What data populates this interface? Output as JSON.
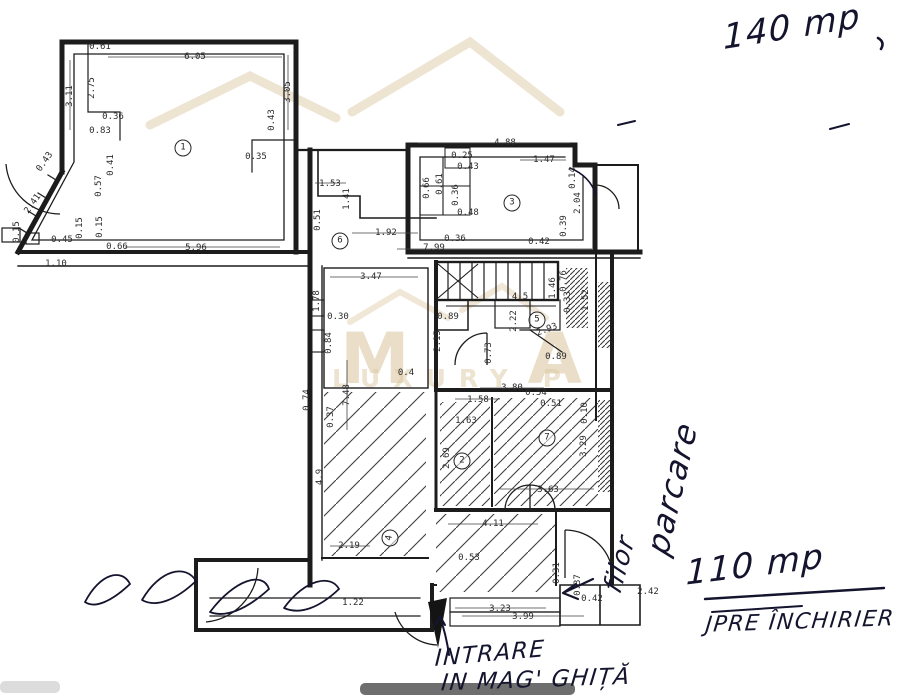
{
  "watermark": {
    "letters": "MA",
    "subtext": "LUXURY P",
    "color": "#d9c49c"
  },
  "plan": {
    "ink": "#1c1c1c",
    "dimensions": [
      {
        "t": "0.61",
        "x": 100,
        "y": 47
      },
      {
        "t": "6.05",
        "x": 195,
        "y": 57
      },
      {
        "t": "3.11",
        "x": 70,
        "y": 96,
        "r": -90
      },
      {
        "t": "2.75",
        "x": 92,
        "y": 88,
        "r": -90
      },
      {
        "t": "0.36",
        "x": 113,
        "y": 117
      },
      {
        "t": "0.83",
        "x": 100,
        "y": 131
      },
      {
        "t": "3.05",
        "x": 288,
        "y": 92,
        "r": -90
      },
      {
        "t": "0.43",
        "x": 272,
        "y": 120,
        "r": -90
      },
      {
        "t": "0.35",
        "x": 256,
        "y": 157
      },
      {
        "t": "0.41",
        "x": 111,
        "y": 165,
        "r": -90
      },
      {
        "t": "0.57",
        "x": 99,
        "y": 186,
        "r": -90
      },
      {
        "t": "0.43",
        "x": 45,
        "y": 162,
        "r": -55
      },
      {
        "t": "2.41",
        "x": 33,
        "y": 204,
        "r": -55
      },
      {
        "t": "0.15",
        "x": 17,
        "y": 232,
        "r": -90
      },
      {
        "t": "0.45",
        "x": 62,
        "y": 240
      },
      {
        "t": "0.15",
        "x": 80,
        "y": 228,
        "r": -90
      },
      {
        "t": "0.15",
        "x": 100,
        "y": 227,
        "r": -90
      },
      {
        "t": "0.66",
        "x": 117,
        "y": 247
      },
      {
        "t": "5.96",
        "x": 196,
        "y": 248
      },
      {
        "t": "1.10",
        "x": 56,
        "y": 264
      },
      {
        "t": "1.53",
        "x": 330,
        "y": 184
      },
      {
        "t": "1.41",
        "x": 347,
        "y": 199,
        "r": -90
      },
      {
        "t": "0.51",
        "x": 318,
        "y": 220,
        "r": -90
      },
      {
        "t": "1.92",
        "x": 386,
        "y": 233
      },
      {
        "t": "7.99",
        "x": 434,
        "y": 248
      },
      {
        "t": "0.36",
        "x": 455,
        "y": 239
      },
      {
        "t": "3.47",
        "x": 371,
        "y": 277
      },
      {
        "t": "1.78",
        "x": 317,
        "y": 301,
        "r": -90
      },
      {
        "t": "0.30",
        "x": 338,
        "y": 317
      },
      {
        "t": "0.84",
        "x": 329,
        "y": 343,
        "r": -90
      },
      {
        "t": "7.48",
        "x": 347,
        "y": 395,
        "r": -90
      },
      {
        "t": "0.74",
        "x": 307,
        "y": 400,
        "r": -90
      },
      {
        "t": "0.37",
        "x": 331,
        "y": 417,
        "r": -90
      },
      {
        "t": "0.4",
        "x": 406,
        "y": 373
      },
      {
        "t": "4.88",
        "x": 505,
        "y": 143
      },
      {
        "t": "0.25",
        "x": 462,
        "y": 156
      },
      {
        "t": "0.43",
        "x": 468,
        "y": 167
      },
      {
        "t": "1.47",
        "x": 544,
        "y": 160
      },
      {
        "t": "0.14",
        "x": 573,
        "y": 178,
        "r": -90
      },
      {
        "t": "0.66",
        "x": 427,
        "y": 188,
        "r": -90
      },
      {
        "t": "0.61",
        "x": 440,
        "y": 184,
        "r": -90
      },
      {
        "t": "0.36",
        "x": 456,
        "y": 195,
        "r": -90
      },
      {
        "t": "0.48",
        "x": 468,
        "y": 213
      },
      {
        "t": "2.04",
        "x": 578,
        "y": 203,
        "r": -90
      },
      {
        "t": "0.39",
        "x": 564,
        "y": 226,
        "r": -90
      },
      {
        "t": "0.42",
        "x": 539,
        "y": 242
      },
      {
        "t": "0.89",
        "x": 448,
        "y": 317
      },
      {
        "t": "4.5",
        "x": 520,
        "y": 297
      },
      {
        "t": "2.22",
        "x": 514,
        "y": 321,
        "r": -90
      },
      {
        "t": "2.93",
        "x": 547,
        "y": 330,
        "r": -20
      },
      {
        "t": "0.76",
        "x": 564,
        "y": 281,
        "r": -90
      },
      {
        "t": "1.46",
        "x": 553,
        "y": 288,
        "r": -90
      },
      {
        "t": "0.33",
        "x": 568,
        "y": 302,
        "r": -90
      },
      {
        "t": "1.52",
        "x": 586,
        "y": 300,
        "r": -90
      },
      {
        "t": "2.15",
        "x": 438,
        "y": 341,
        "r": -90
      },
      {
        "t": "0.73",
        "x": 489,
        "y": 353,
        "r": -90
      },
      {
        "t": "0.89",
        "x": 556,
        "y": 357
      },
      {
        "t": "3.80",
        "x": 512,
        "y": 388
      },
      {
        "t": "0.54",
        "x": 536,
        "y": 393
      },
      {
        "t": "0.51",
        "x": 551,
        "y": 404
      },
      {
        "t": "1.58",
        "x": 478,
        "y": 400
      },
      {
        "t": "1.63",
        "x": 466,
        "y": 421
      },
      {
        "t": "2.69",
        "x": 447,
        "y": 458,
        "r": -90
      },
      {
        "t": "0.10",
        "x": 585,
        "y": 413,
        "r": -90
      },
      {
        "t": "3.29",
        "x": 584,
        "y": 446,
        "r": -90
      },
      {
        "t": "3.63",
        "x": 548,
        "y": 490
      },
      {
        "t": "4.11",
        "x": 493,
        "y": 524
      },
      {
        "t": "0.53",
        "x": 469,
        "y": 558
      },
      {
        "t": "4.9",
        "x": 320,
        "y": 477,
        "r": -90
      },
      {
        "t": "2.19",
        "x": 349,
        "y": 546
      },
      {
        "t": "1.22",
        "x": 353,
        "y": 603
      },
      {
        "t": "3.23",
        "x": 500,
        "y": 609
      },
      {
        "t": "3.99",
        "x": 523,
        "y": 617
      },
      {
        "t": "0.31",
        "x": 557,
        "y": 573,
        "r": -90
      },
      {
        "t": "0.37",
        "x": 578,
        "y": 585,
        "r": -90
      },
      {
        "t": "0.42",
        "x": 592,
        "y": 599
      },
      {
        "t": "2.42",
        "x": 648,
        "y": 592
      }
    ],
    "rooms": [
      {
        "n": "1",
        "x": 183,
        "y": 148
      },
      {
        "n": "6",
        "x": 340,
        "y": 241
      },
      {
        "n": "3",
        "x": 512,
        "y": 203
      },
      {
        "n": "5",
        "x": 537,
        "y": 320
      },
      {
        "n": "2",
        "x": 462,
        "y": 461
      },
      {
        "n": "7",
        "x": 547,
        "y": 438
      },
      {
        "n": "4",
        "x": 390,
        "y": 538,
        "r": -80
      }
    ]
  },
  "annotations": {
    "ink": "#14142e",
    "notes": [
      {
        "t": "140 mp",
        "x": 792,
        "y": 27,
        "r": -9,
        "s": 34
      },
      {
        "t": "parcare",
        "x": 672,
        "y": 488,
        "r": -77,
        "s": 32
      },
      {
        "t": "filor",
        "x": 620,
        "y": 564,
        "r": -75,
        "s": 26
      },
      {
        "t": "110 mp",
        "x": 755,
        "y": 565,
        "r": -7,
        "s": 34
      },
      {
        "t": "JPRE ÎNCHIRIER",
        "x": 800,
        "y": 622,
        "r": -2,
        "s": 22
      },
      {
        "t": "INTRARE",
        "x": 490,
        "y": 654,
        "r": -5,
        "s": 23
      },
      {
        "t": "IN MAG' GHIȚĂ",
        "x": 536,
        "y": 680,
        "r": -2,
        "s": 23
      }
    ]
  }
}
